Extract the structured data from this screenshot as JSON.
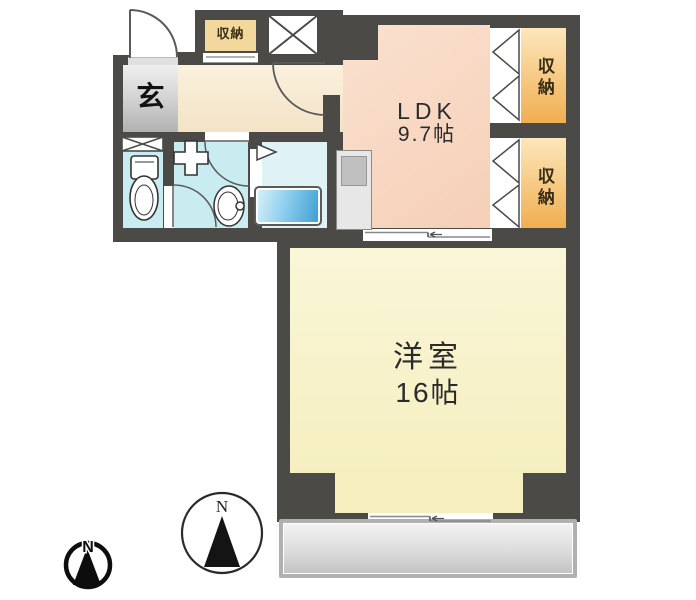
{
  "floorplan": {
    "type": "japanese-apartment-floorplan",
    "labels": {
      "entrance": "玄",
      "ldk_name": "LDK",
      "ldk_size": "9.7帖",
      "western_name": "洋室",
      "western_size": "16帖",
      "storage": "収納",
      "north": "N"
    },
    "rooms": [
      {
        "name": "entrance",
        "label": "玄"
      },
      {
        "name": "ldk",
        "label": "LDK 9.7帖"
      },
      {
        "name": "western-room",
        "label": "洋室 16帖"
      },
      {
        "name": "storage-top",
        "label": "収納"
      },
      {
        "name": "storage-upper",
        "label": "収納"
      },
      {
        "name": "storage-lower",
        "label": "収納"
      },
      {
        "name": "toilet",
        "label": ""
      },
      {
        "name": "washroom",
        "label": ""
      },
      {
        "name": "bathroom",
        "label": ""
      },
      {
        "name": "balcony",
        "label": ""
      }
    ],
    "icons": [
      "north-compass-icon",
      "small-north-compass-icon",
      "toilet-icon",
      "washbasin-icon",
      "washer-pan-icon",
      "x-shaft-icon",
      "x-window-icon",
      "folding-door-icon",
      "sliding-door-icon"
    ],
    "colors": {
      "wall": "#4b4a47",
      "ldk_floor": "#f7d3bd",
      "western_floor": "#f8f3cb",
      "hallway_floor": "#f6ebd5",
      "entrance_floor": "#cfcfcf",
      "wet_area_floor": "#c9ecf1",
      "bath_floor": "#dff3f6",
      "bathtub": "#58abd8",
      "storage_floor": "#f4bc68",
      "storage_box_top": "#f3d89e",
      "balcony": "#d9d9d9",
      "text": "#2b2b2b"
    }
  }
}
